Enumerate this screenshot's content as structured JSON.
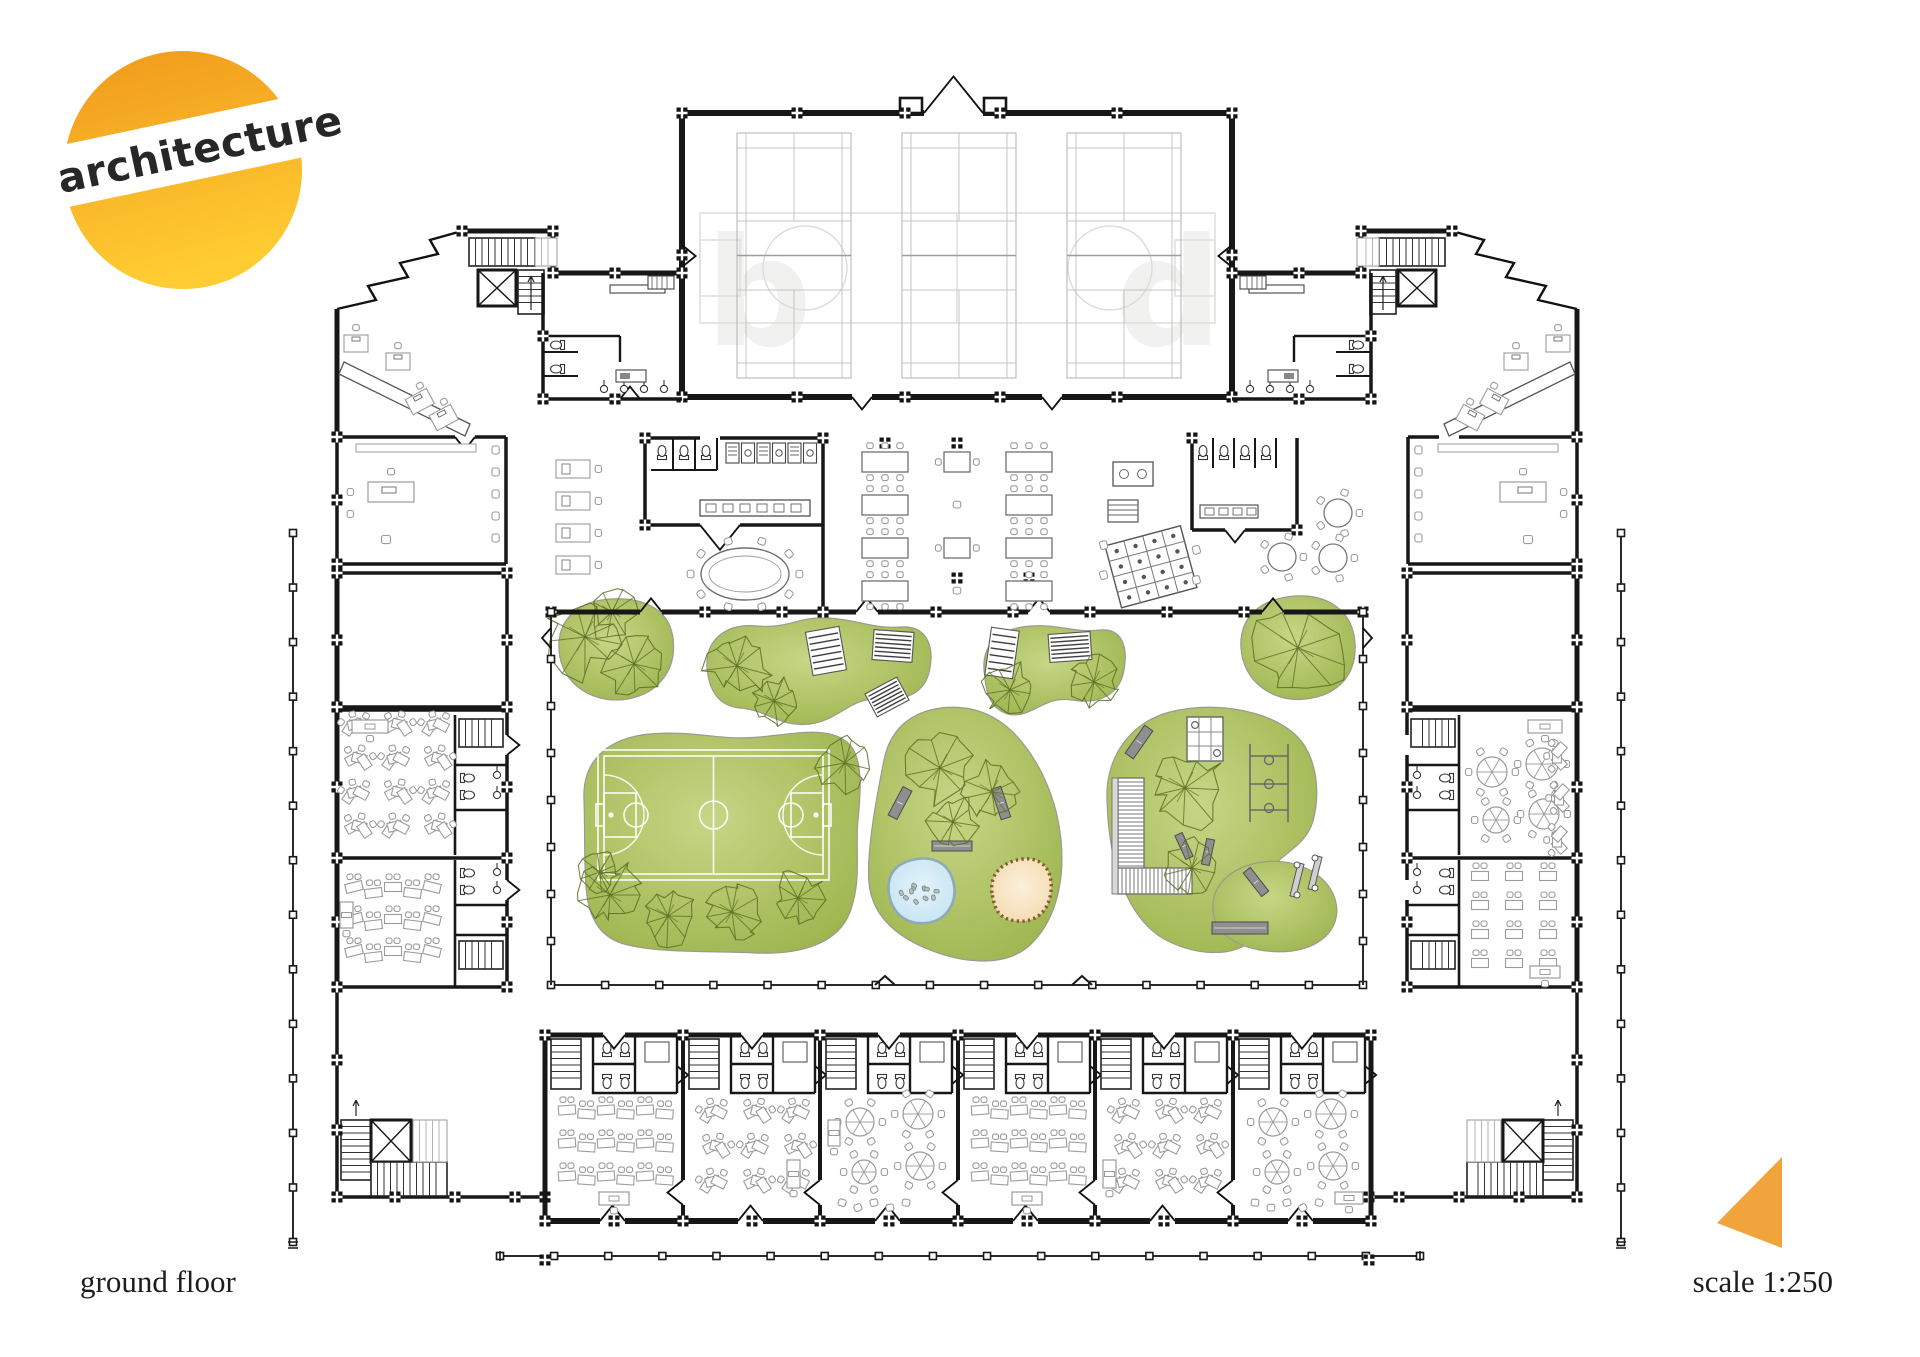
{
  "page": {
    "background_color": "#ffffff",
    "width": 1920,
    "height": 1357
  },
  "logo": {
    "text": "architecture",
    "gradient_top_color": "#F0991B",
    "gradient_bottom_color": "#FFCC32",
    "band_color": "#ffffff",
    "text_color": "#272727",
    "rotation_deg": -12
  },
  "footer": {
    "floor_label": "ground floor",
    "scale_label": "scale 1:250",
    "text_color": "#1d1d1b"
  },
  "scale_marker": {
    "shape": "triangle",
    "color": "#F2A43C"
  },
  "plan": {
    "watermark_letters": "bd",
    "palette": {
      "wall": "#171717",
      "furniture": "#9b9b9b",
      "dark_furniture": "#606060",
      "faint": "#eaeae8",
      "court_faint": "#dcdcda",
      "grass_light": "#c7d686",
      "grass_dark": "#9ab24a",
      "grass_edge": "#9a9a90",
      "tree": "#5c7026",
      "pond_fill": "#cfe9f6",
      "pond_edge": "#8fa9b6",
      "stone": "#b7bfbf",
      "sand_fill": "#f8e5c3",
      "sand_edge": "#8a5a34",
      "court_line": "#ffffff",
      "bench": "#8f8f8f"
    },
    "areas": [
      "sports-hall",
      "badminton-court",
      "changing-rooms",
      "entrance-lobby",
      "stair",
      "elevator",
      "reception",
      "office",
      "kitchen",
      "dining-hall",
      "meeting-table",
      "playroom",
      "toilets",
      "classroom",
      "courtyard",
      "lawn",
      "basketball-court",
      "playground",
      "pond",
      "sandpit",
      "picnic-mat",
      "bench",
      "covered-walkway"
    ],
    "counts": {
      "badminton_courts": 3,
      "green_areas": 8,
      "bottom_classrooms": 6,
      "dining_table_columns": 3
    }
  }
}
